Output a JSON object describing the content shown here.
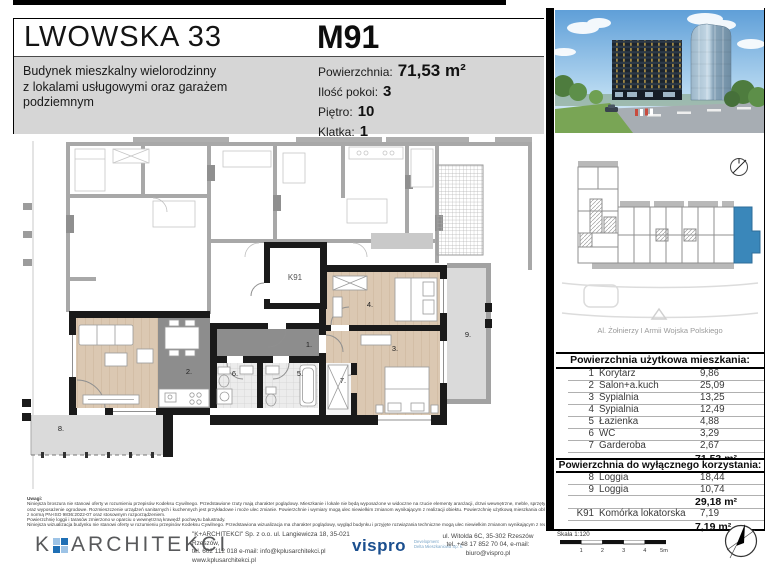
{
  "header": {
    "project": "LWOWSKA 33",
    "description": "Budynek mieszkalny wielorodzinny\nz lokalami usługowymi oraz garażem\npodziemnym",
    "unit": "M91",
    "specs": [
      {
        "label": "Powierzchnia:",
        "value": "71,53 m²"
      },
      {
        "label": "Ilość pokoi:",
        "value": "3"
      },
      {
        "label": "Piętro:",
        "value": "10"
      },
      {
        "label": "Klatka:",
        "value": "1"
      }
    ]
  },
  "plan": {
    "labels": {
      "r1": "1.",
      "r2": "2.",
      "r3": "3.",
      "r4": "4.",
      "r5": "5.",
      "r6": "6.",
      "r7": "7.",
      "r8": "8.",
      "r9": "9.",
      "k91": "K91"
    }
  },
  "sidebar": {
    "street": "Al. Żołnierzy I Armii Wojska Polskiego",
    "usable": {
      "title": "Powierzchnia użytkowa mieszkania:",
      "rows": [
        {
          "no": "1",
          "name": "Korytarz",
          "area": "9,86"
        },
        {
          "no": "2",
          "name": "Salon+a.kuch",
          "area": "25,09"
        },
        {
          "no": "3",
          "name": "Sypialnia",
          "area": "13,25"
        },
        {
          "no": "4",
          "name": "Sypialnia",
          "area": "12,49"
        },
        {
          "no": "5",
          "name": "Łazienka",
          "area": "4,88"
        },
        {
          "no": "6",
          "name": "WC",
          "area": "3,29"
        },
        {
          "no": "7",
          "name": "Garderoba",
          "area": "2,67"
        }
      ],
      "total": "71,53 m²"
    },
    "exclusive": {
      "title": "Powierzchnia do wyłącznego korzystania:",
      "rows": [
        {
          "no": "8",
          "name": "Loggia",
          "area": "18,44"
        },
        {
          "no": "9",
          "name": "Loggia",
          "area": "10,74"
        }
      ],
      "total": "29,18 m²",
      "storage_row": {
        "no": "K91",
        "name": "Komórka lokatorska",
        "area": "7,19"
      },
      "storage_total": "7,19 m²"
    },
    "scale": {
      "label": "Skala 1:120",
      "ticks": [
        "1",
        "2",
        "3",
        "4",
        "5m"
      ]
    }
  },
  "footer": {
    "notes_title": "Uwagi:",
    "notes": [
      "Niniejsza broszura nie stanowi oferty w rozumieniu przepisów Kodeksu Cywilnego. Przedstawione rzuty mają charakter poglądowy. Mieszkanie i lokale nie będą wyposażone w widoczne na rzucie elementy aranżacji, drzwi wewnętrzne, meble, sprzęty RTV i AGD",
      "oraz wyposażenie ogrodowe. Rozmieszczenie urządzeń sanitarnych i kuchennych jest przykładowe i może ulec zmianie. Powierzchnie i wymiary mogą ulec niewielkim zmianom wynikającym z realizacji obiektu. Powierzchnię użytkową mieszkania obliczono zgodnie",
      "z normą PN-ISO 9836:2022-07 oraz stosownym rozporządzeniem.",
      "Powierzchnię loggii i tarasów zmierzono w oparciu o wewnętrzną krawędź pochwytu balustrady.",
      "Niniejsza wizualizacja budynku nie stanowi oferty w rozumieniu przepisów Kodeksu Cywilnego. Przedstawiona wizualizacja ma charakter poglądowy, wygląd budynku i przyjęte rozwiązania techniczne mogą ulec niewielkim zmianom wynikającym z realizacji obiektu."
    ],
    "architect": {
      "logo_k": "K",
      "logo_name": "ARCHITEKCI",
      "line1": "\"K+ARCHITEKCI\" Sp. z o.o. ul. Langiewicza 18, 35-021 Rzeszów,",
      "line2": "tel. 602 112 018 e-mail: info@kplusarchitekci.pl",
      "line3": "www.kplusarchitekci.pl"
    },
    "developer": {
      "logo": "vispro",
      "tag1": "Development",
      "tag2": "Delta Mieszkaniowa Sp. k.",
      "addr1": "ul. Witolda 6C, 35-302 Rzeszów",
      "addr2": "tel. +48 17 852 70 04, e-mail: biuro@vispro.pl"
    }
  },
  "colors": {
    "highlight_unit_blue": "#3a87ba",
    "band_gray": "#d6d6d6",
    "wood": "#dbc8b2",
    "tile_dark": "#8d8d8d",
    "loggia_gray": "#dadada"
  }
}
